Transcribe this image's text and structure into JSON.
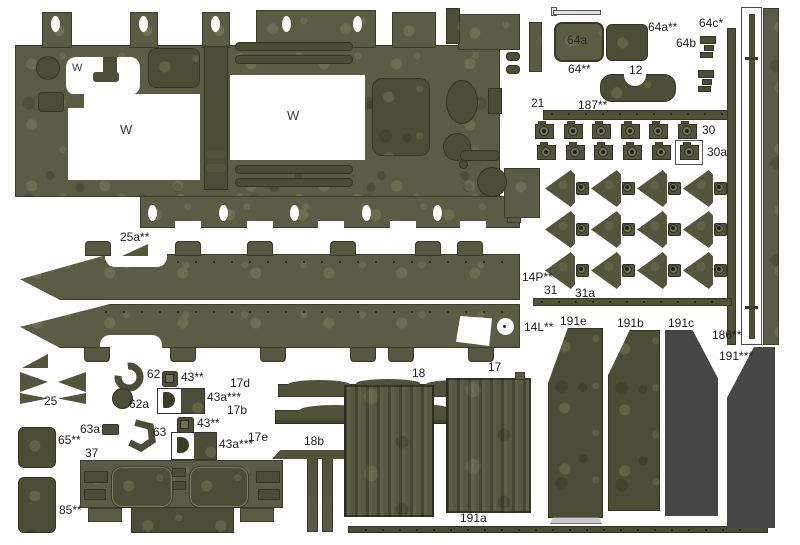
{
  "colors": {
    "olive": "#5a5c45",
    "olive_dark": "#4b4d36",
    "olive_deep": "#3f4129",
    "page_background": "#ffffff",
    "label_ink": "#1c1c1c"
  },
  "labels": {
    "w": "W",
    "p25a": "25a**",
    "p14p": "14P**",
    "p31": "31",
    "p31a": "31a",
    "p14l": "14L**",
    "p25": "25",
    "p62": "62",
    "p62a": "62a",
    "p43b1": "43**",
    "p43a1": "43a***",
    "p43b2": "43**",
    "p43a2": "43a***",
    "p17d": "17d",
    "p17b": "17b",
    "p17e": "17e",
    "p18b": "18b",
    "p63a": "63a",
    "p63": "63",
    "p65": "65**",
    "p37": "37",
    "p85": "85**",
    "p18": "18",
    "p17": "17",
    "p191a": "191a",
    "p191e": "191e",
    "p191b": "191b",
    "p191c": "191c",
    "p186": "186**",
    "p191s": "191***",
    "p21": "21",
    "p187": "187**",
    "p30": "30",
    "p30a": "30a",
    "p64a": "64a",
    "p64": "64**",
    "p64as": "64a**",
    "p64c": "64c*",
    "p64b": "64b",
    "p12": "12"
  },
  "counts": {
    "sheet_top_holes": 5,
    "sheet_bottom_holes": 5,
    "skirt_top_tabs": 6,
    "skirt_bottom_tabs": 6,
    "studs_row1": 6,
    "studs_row2_plain": 5,
    "studs_row2_boxed": 1,
    "triangle_rows": 3,
    "triangle_cols": 4
  }
}
